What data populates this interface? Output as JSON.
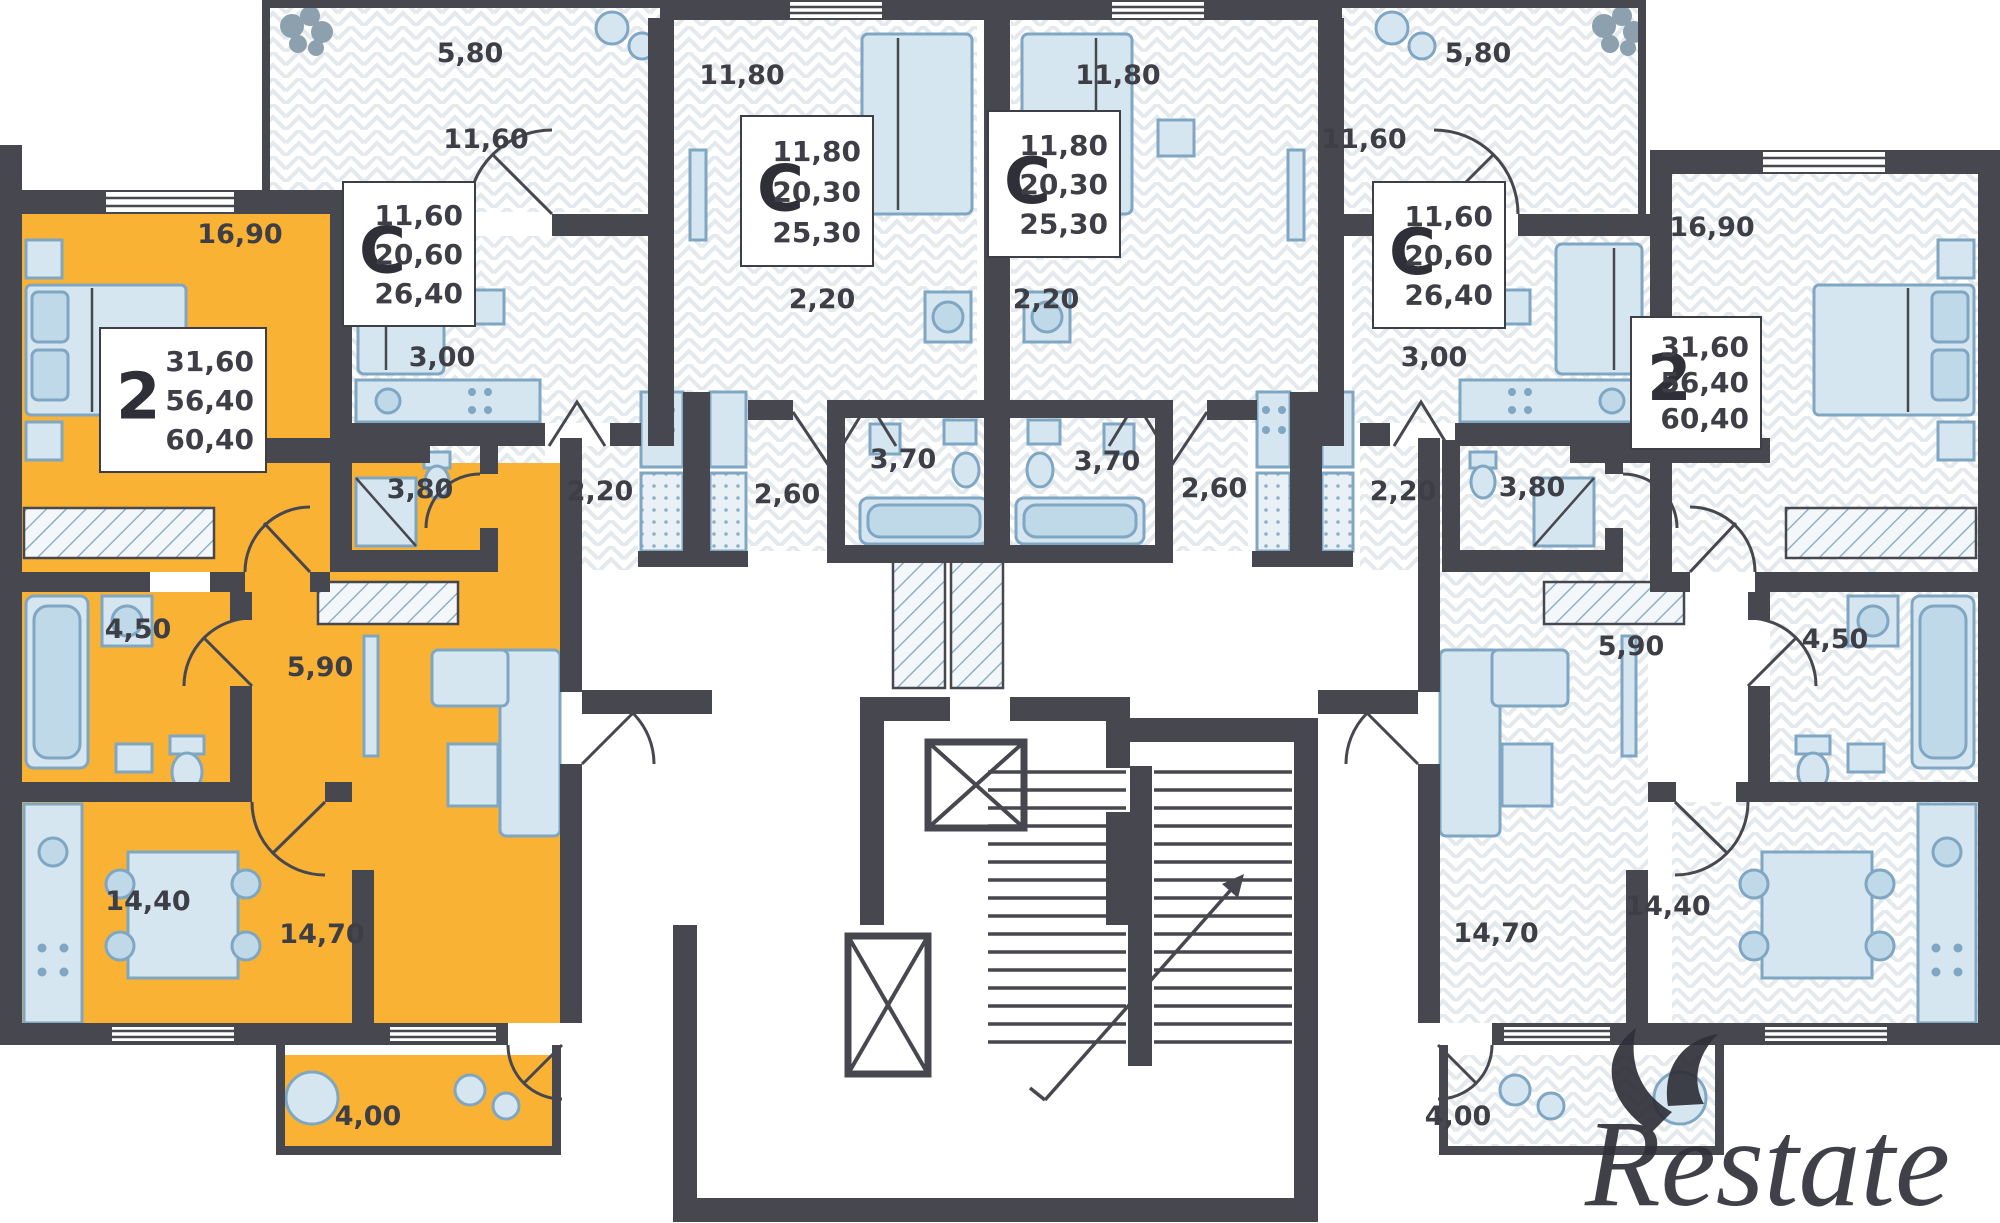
{
  "watermark": {
    "text": "Restate"
  },
  "colors": {
    "highlight": "#F9B233",
    "wall": "#47474F",
    "furniture": "#D6E6F0",
    "furniture_stroke": "#7FA6C2",
    "label": "#3E3E46",
    "pattern_line": "#E4E9ED"
  },
  "info_boxes": [
    {
      "type": "2",
      "values": [
        "31,60",
        "56,40",
        "60,40"
      ],
      "x": 100,
      "y": 328,
      "w": 166,
      "h": 144
    },
    {
      "type": "С",
      "values": [
        "11,60",
        "20,60",
        "26,40"
      ],
      "x": 343,
      "y": 182,
      "w": 132,
      "h": 144
    },
    {
      "type": "С",
      "values": [
        "11,80",
        "20,30",
        "25,30"
      ],
      "x": 741,
      "y": 116,
      "w": 132,
      "h": 150
    },
    {
      "type": "С",
      "values": [
        "11,80",
        "20,30",
        "25,30"
      ],
      "x": 988,
      "y": 111,
      "w": 132,
      "h": 146
    },
    {
      "type": "С",
      "values": [
        "11,60",
        "20,60",
        "26,40"
      ],
      "x": 1373,
      "y": 182,
      "w": 132,
      "h": 146
    },
    {
      "type": "2",
      "values": [
        "31,60",
        "56,40",
        "60,40"
      ],
      "x": 1631,
      "y": 317,
      "w": 130,
      "h": 132
    }
  ],
  "room_labels": [
    {
      "text": "5,80",
      "x": 470,
      "y": 62
    },
    {
      "text": "11,80",
      "x": 742,
      "y": 84
    },
    {
      "text": "11,80",
      "x": 1118,
      "y": 84
    },
    {
      "text": "5,80",
      "x": 1478,
      "y": 62
    },
    {
      "text": "11,60",
      "x": 486,
      "y": 148
    },
    {
      "text": "11,60",
      "x": 1364,
      "y": 148
    },
    {
      "text": "16,90",
      "x": 240,
      "y": 243
    },
    {
      "text": "16,90",
      "x": 1712,
      "y": 236
    },
    {
      "text": "3,00",
      "x": 442,
      "y": 366
    },
    {
      "text": "3,00",
      "x": 1434,
      "y": 366
    },
    {
      "text": "2,20",
      "x": 822,
      "y": 308
    },
    {
      "text": "2,20",
      "x": 1046,
      "y": 308
    },
    {
      "text": "3,80",
      "x": 420,
      "y": 498
    },
    {
      "text": "2,20",
      "x": 600,
      "y": 500
    },
    {
      "text": "2,60",
      "x": 787,
      "y": 503
    },
    {
      "text": "3,70",
      "x": 903,
      "y": 468
    },
    {
      "text": "3,70",
      "x": 1107,
      "y": 470
    },
    {
      "text": "2,60",
      "x": 1214,
      "y": 497
    },
    {
      "text": "2,20",
      "x": 1403,
      "y": 500
    },
    {
      "text": "3,80",
      "x": 1532,
      "y": 496
    },
    {
      "text": "4,50",
      "x": 138,
      "y": 638
    },
    {
      "text": "5,90",
      "x": 320,
      "y": 676
    },
    {
      "text": "5,90",
      "x": 1631,
      "y": 655
    },
    {
      "text": "4,50",
      "x": 1835,
      "y": 648
    },
    {
      "text": "14,40",
      "x": 148,
      "y": 910
    },
    {
      "text": "14,70",
      "x": 322,
      "y": 943
    },
    {
      "text": "14,70",
      "x": 1496,
      "y": 942
    },
    {
      "text": "14,40",
      "x": 1668,
      "y": 915
    },
    {
      "text": "4,00",
      "x": 368,
      "y": 1125
    },
    {
      "text": "4,00",
      "x": 1458,
      "y": 1125
    }
  ]
}
